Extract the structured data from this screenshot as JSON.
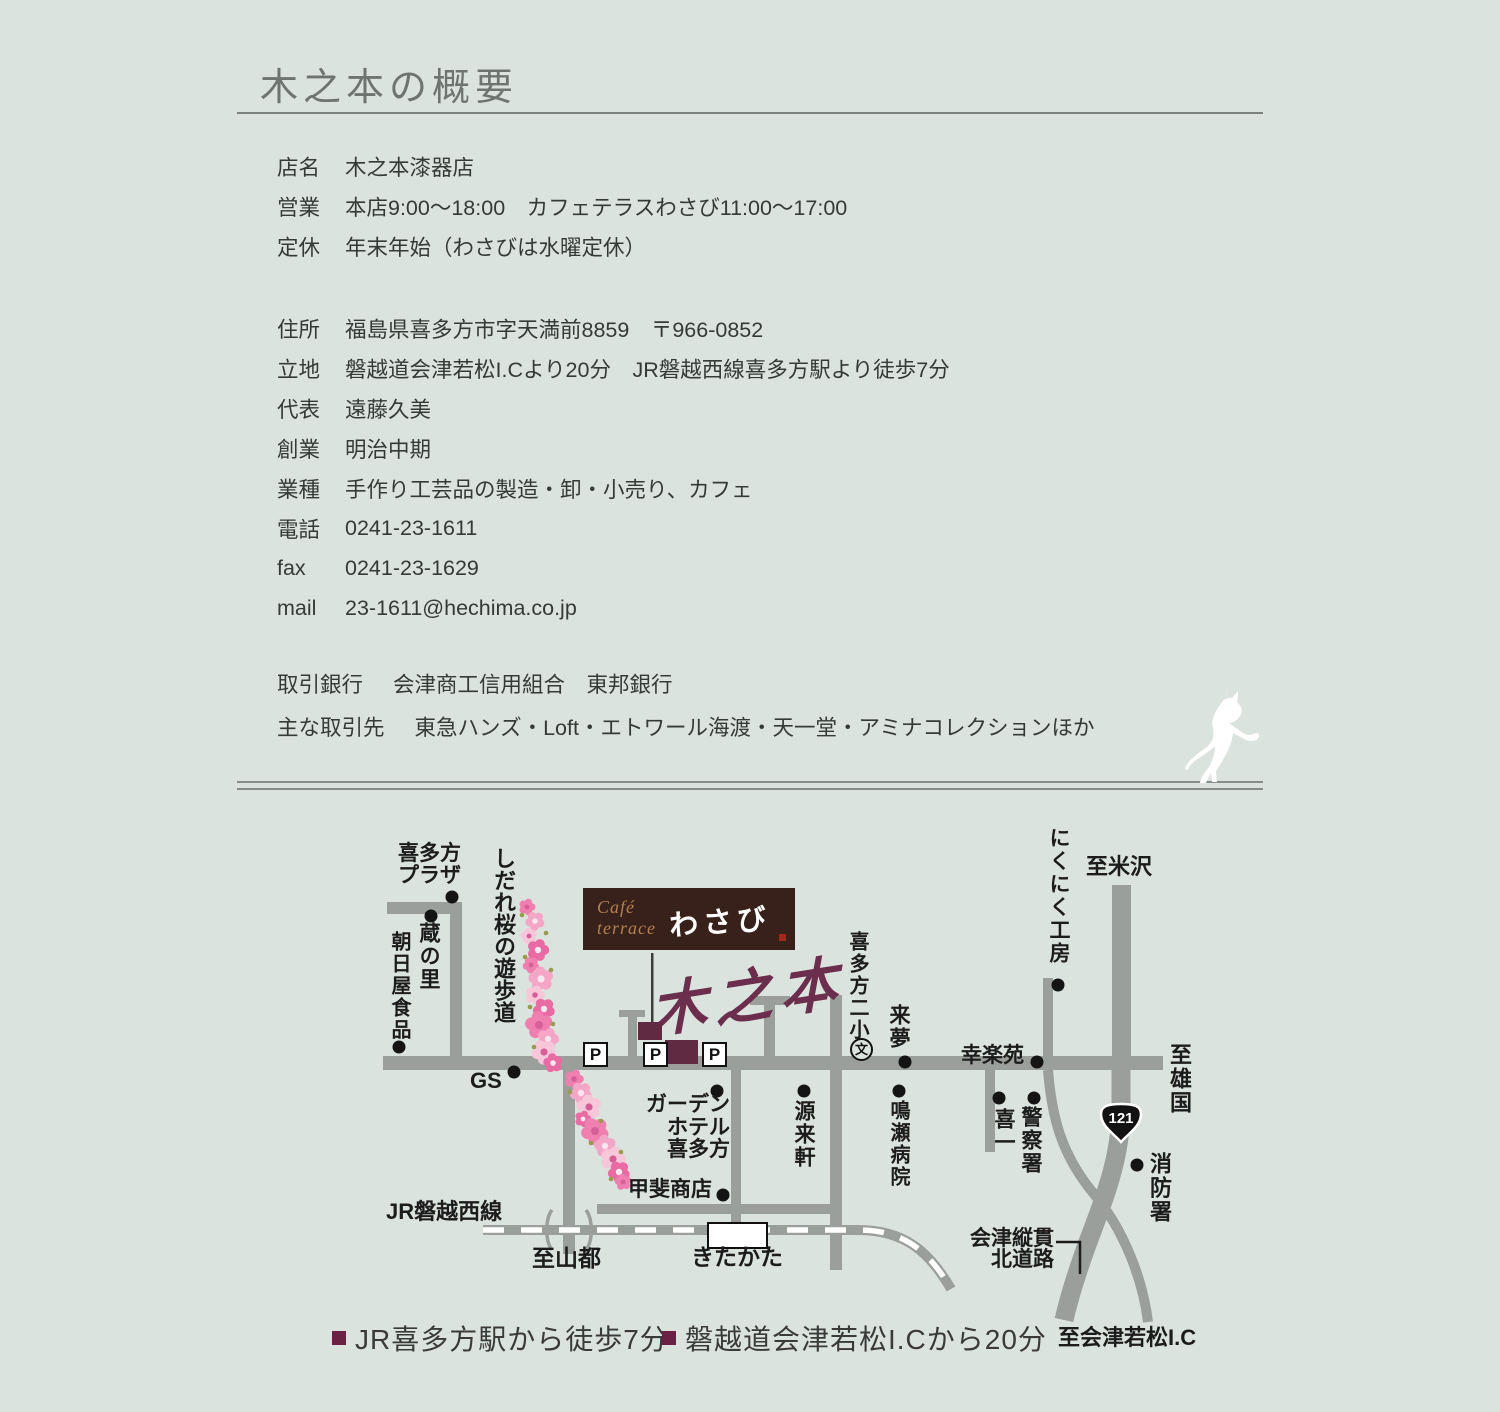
{
  "page": {
    "title": "木之本の概要"
  },
  "info": {
    "rows": [
      {
        "label": "店名",
        "value": "木之本漆器店"
      },
      {
        "label": "営業",
        "value": "本店9:00〜18:00　カフェテラスわさび11:00〜17:00"
      },
      {
        "label": "定休",
        "value": "年末年始（わさびは水曜定休）"
      },
      {
        "label": "住所",
        "value": "福島県喜多方市字天満前8859　〒966-0852"
      },
      {
        "label": "立地",
        "value": "磐越道会津若松I.Cより20分　JR磐越西線喜多方駅より徒歩7分"
      },
      {
        "label": "代表",
        "value": "遠藤久美"
      },
      {
        "label": "創業",
        "value": "明治中期"
      },
      {
        "label": "業種",
        "value": "手作り工芸品の製造・卸・小売り、カフェ"
      },
      {
        "label": "電話",
        "value": "0241-23-1611"
      },
      {
        "label": "fax",
        "value": "0241-23-1629"
      },
      {
        "label": "mail",
        "value": "23-1611@hechima.co.jp"
      }
    ]
  },
  "partners": {
    "rows": [
      {
        "label": "取引銀行",
        "value": "会津商工信用組合　東邦銀行"
      },
      {
        "label": "主な取引先",
        "value": "東急ハンズ・Loft・エトワール海渡・天一堂・アミナコレクションほか"
      }
    ]
  },
  "map": {
    "cafe_sign": {
      "line1": "Café",
      "line2": "terrace",
      "name": "わさび"
    },
    "logo": "木之本",
    "route_badge": "121",
    "parking_label": "P",
    "school_symbol": "文",
    "labels": {
      "plaza": "喜多方\nプラザ",
      "kura_no_sato": "蔵の里",
      "asahiya": "朝日屋食品",
      "shidare": "しだれ桜の遊歩道",
      "gs": "GS",
      "jr_line": "JR磐越西線",
      "to_yamato": "至山都",
      "station": "きたかた",
      "kai_shoten": "甲斐商店",
      "garden_hotel": "ガーデン\nホテル\n喜多方",
      "genraiken": "源来軒",
      "naruse": "鳴瀬病院",
      "nisho": "喜多方二小",
      "raimu": "来夢",
      "kourakuen": "幸楽苑",
      "kiichi": "喜一",
      "keisatsu": "警察署",
      "nikuniku": "にくにく工房",
      "to_yonezawa": "至米沢",
      "to_oguni": "至雄国",
      "shobosho": "消防署",
      "jukan": "会津縦貫\n北道路",
      "to_wakamatsu_ic": "至会津若松I.C"
    }
  },
  "footer": {
    "items": [
      {
        "text": "JR喜多方駅から徒歩7分"
      },
      {
        "text": "磐越道会津若松I.Cから20分"
      }
    ]
  },
  "colors": {
    "background": "#dbe3de",
    "road": "#9b9f9c",
    "building_maroon": "#5f2a42",
    "legend_maroon": "#6b2144",
    "cafe_brown": "#38211a",
    "cafe_gold": "#b28052",
    "blossom_pink": "#ee7fae",
    "seal_red": "#a3281c",
    "title_gray": "#6e7471"
  }
}
